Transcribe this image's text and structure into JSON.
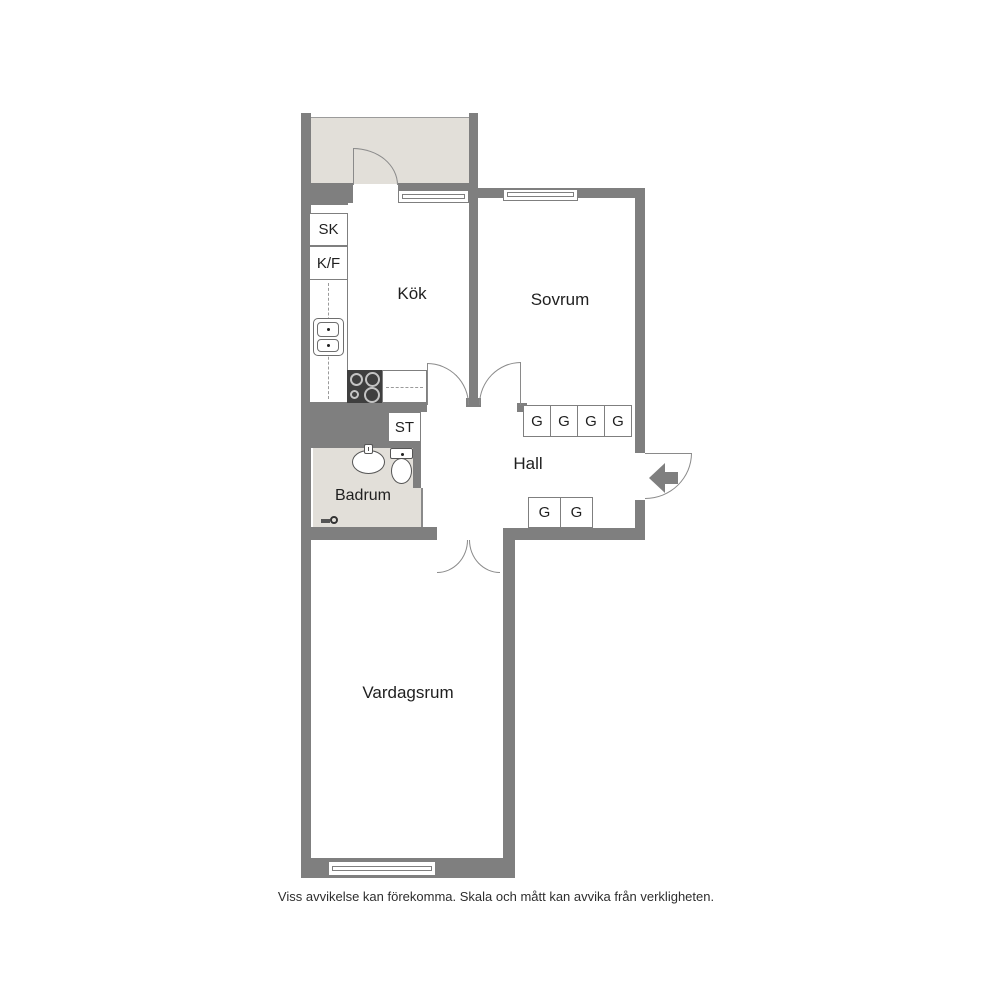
{
  "plan": {
    "rooms": {
      "kitchen": "Kök",
      "bedroom": "Sovrum",
      "hall": "Hall",
      "bathroom": "Badrum",
      "living_room": "Vardagsrum"
    },
    "closets": {
      "sk": "SK",
      "kf": "K/F",
      "st": "ST"
    },
    "wardrobes": {
      "bedroom_row": [
        "G",
        "G",
        "G",
        "G"
      ],
      "hall_row": [
        "G",
        "G"
      ]
    }
  },
  "caption": "Viss avvikelse kan förekomma. Skala och mått kan avvika från verkligheten.",
  "colors": {
    "wall": "#7f7f7f",
    "secondary_area_fill": "#e2dfd9",
    "door_line": "#8a8a8a",
    "text": "#1f1f1f",
    "background": "#ffffff"
  }
}
